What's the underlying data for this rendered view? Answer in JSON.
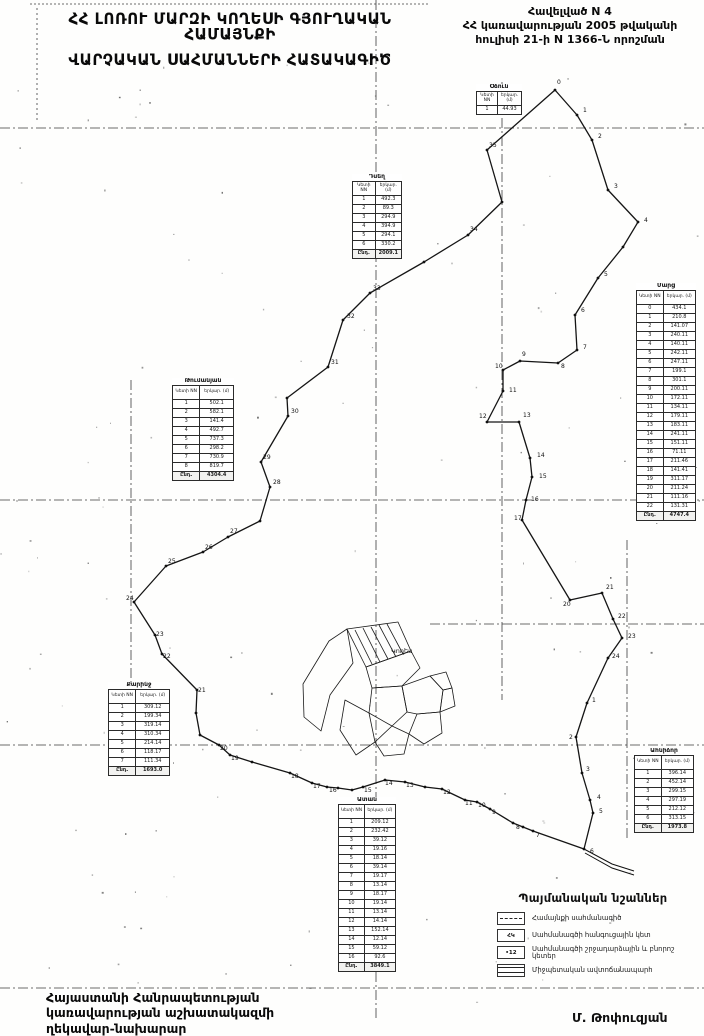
{
  "header": {
    "title_line1": "ՀՀ ԼՈՌՈՒ ՄԱՐԶԻ ԿՈՂԵՍԻ ԳՅՈՒՂԱԿԱՆ ՀԱՄԱՅՆՔԻ",
    "title_line2": "ՎԱՐՉԱԿԱՆ ՍԱՀՄԱՆՆԵՐԻ ՀԱՏԱԿԱԳԻԾ"
  },
  "annex": {
    "line1": "Հավելված N 4",
    "line2": "ՀՀ կառավարության  2005 թվականի",
    "line3": "հուլիսի 21-ի N 1366-Ն որոշման"
  },
  "map": {
    "village_label": "Կողես",
    "village_label_x": 391,
    "village_label_y": 653,
    "boundary": "555,90 577,115 592,140 608,190 638,222 623,247 598,278 575,315 577,350 558,363 520,361 503,370 503,391 487,422 519,422 530,458 532,477 526,500 522,520 570,600 602,593 613,619 622,638 608,658 587,703 576,737 582,773 590,800 593,813 584,849 533,831 523,827 513,823 490,809 477,802 465,800 442,789 425,787 405,782 385,780 363,787 352,790 338,788 327,787 312,783 290,773 252,762 230,755 219,745 200,735 196,713 197,690 162,654 155,635 134,602 166,566 203,552 228,537 260,521 270,487 261,462 288,416 287,398 328,367 343,320 370,293 424,262 468,235 502,202 487,150",
    "grid": [
      {
        "x1": 30,
        "y1": 4,
        "x2": 430,
        "y2": 4,
        "dash": "2 2"
      },
      {
        "x1": 0,
        "y1": 128,
        "x2": 704,
        "y2": 128,
        "dash": "10 3 2 3"
      },
      {
        "x1": 0,
        "y1": 500,
        "x2": 704,
        "y2": 500,
        "dash": "10 3 2 3"
      },
      {
        "x1": 430,
        "y1": 624,
        "x2": 704,
        "y2": 624,
        "dash": "10 3 2 3"
      },
      {
        "x1": 0,
        "y1": 745,
        "x2": 704,
        "y2": 745,
        "dash": "10 3 2 3"
      },
      {
        "x1": 0,
        "y1": 988,
        "x2": 704,
        "y2": 988,
        "dash": "10 3 2 3"
      },
      {
        "x1": 37,
        "y1": 8,
        "x2": 37,
        "y2": 120,
        "dash": "2 3"
      },
      {
        "x1": 131,
        "y1": 380,
        "x2": 131,
        "y2": 760,
        "dash": "10 3 2 3"
      },
      {
        "x1": 376,
        "y1": 0,
        "x2": 376,
        "y2": 1020,
        "dash": "10 3 2 3"
      },
      {
        "x1": 502,
        "y1": 82,
        "x2": 502,
        "y2": 700,
        "dash": "10 3 2 3"
      },
      {
        "x1": 627,
        "y1": 540,
        "x2": 627,
        "y2": 840,
        "dash": "10 3 2 3"
      }
    ],
    "point_labels": [
      [
        557,
        84,
        "0"
      ],
      [
        583,
        112,
        "1"
      ],
      [
        598,
        138,
        "2"
      ],
      [
        614,
        188,
        "3"
      ],
      [
        644,
        222,
        "4"
      ],
      [
        604,
        276,
        "5"
      ],
      [
        581,
        312,
        "6"
      ],
      [
        583,
        349,
        "7"
      ],
      [
        561,
        368,
        "8"
      ],
      [
        522,
        356,
        "9"
      ],
      [
        495,
        368,
        "10"
      ],
      [
        509,
        392,
        "11"
      ],
      [
        479,
        418,
        "12"
      ],
      [
        523,
        417,
        "13"
      ],
      [
        537,
        457,
        "14"
      ],
      [
        539,
        478,
        "15"
      ],
      [
        531,
        501,
        "16"
      ],
      [
        514,
        520,
        "17"
      ],
      [
        563,
        606,
        "20"
      ],
      [
        606,
        589,
        "21"
      ],
      [
        618,
        618,
        "22"
      ],
      [
        628,
        638,
        "23"
      ],
      [
        612,
        658,
        "24"
      ],
      [
        592,
        702,
        "1"
      ],
      [
        569,
        739,
        "2"
      ],
      [
        586,
        771,
        "3"
      ],
      [
        597,
        799,
        "4"
      ],
      [
        599,
        813,
        "5"
      ],
      [
        590,
        853,
        "6"
      ],
      [
        536,
        837,
        "7"
      ],
      [
        516,
        829,
        "8"
      ],
      [
        492,
        814,
        "9"
      ],
      [
        478,
        807,
        "10"
      ],
      [
        465,
        805,
        "11"
      ],
      [
        443,
        794,
        "12"
      ],
      [
        406,
        787,
        "13"
      ],
      [
        385,
        785,
        "14"
      ],
      [
        364,
        792,
        "15"
      ],
      [
        329,
        792,
        "16"
      ],
      [
        313,
        788,
        "17"
      ],
      [
        291,
        778,
        "18"
      ],
      [
        231,
        760,
        "19"
      ],
      [
        220,
        750,
        "20"
      ],
      [
        198,
        692,
        "21"
      ],
      [
        163,
        658,
        "22"
      ],
      [
        156,
        636,
        "23"
      ],
      [
        126,
        600,
        "24"
      ],
      [
        168,
        563,
        "25"
      ],
      [
        205,
        549,
        "26"
      ],
      [
        230,
        533,
        "27"
      ],
      [
        273,
        484,
        "28"
      ],
      [
        263,
        459,
        "29"
      ],
      [
        291,
        413,
        "30"
      ],
      [
        331,
        364,
        "31"
      ],
      [
        347,
        318,
        "32"
      ],
      [
        373,
        290,
        "33"
      ],
      [
        470,
        231,
        "34"
      ],
      [
        489,
        147,
        "35"
      ]
    ],
    "village_polygons": [
      "303,684 329,641 347,629 353,663 330,695 321,731 304,717",
      "347,629 398,622 411,651 366,667",
      "366,667 411,651 420,668 402,686 372,688",
      "372,688 402,686 407,712 392,726 369,713",
      "402,686 430,676 443,690 440,712 417,714 407,712",
      "417,714 440,712 442,733 424,744 409,734",
      "392,726 409,734 404,754 384,756 375,742",
      "345,700 369,713 375,742 356,755 340,730",
      "430,676 446,672 452,688 443,690",
      "443,690 452,688 455,706 440,712"
    ],
    "village_stripes": [
      [
        355,
        630,
        372,
        664
      ],
      [
        363,
        628,
        380,
        662
      ],
      [
        371,
        627,
        388,
        659
      ],
      [
        379,
        625,
        396,
        657
      ],
      [
        387,
        624,
        403,
        654
      ]
    ],
    "road": [
      "584,849 612,864 634,871",
      "585,853 612,868 634,875"
    ]
  },
  "tables": [
    {
      "title": "Օձուն",
      "x": 476,
      "y": 84,
      "w": 46,
      "hdr": [
        "Կետի NN",
        "երկար. (մ)"
      ],
      "rows": [
        [
          "1",
          "44.93"
        ]
      ],
      "total": null
    },
    {
      "title": "Դսեղ",
      "x": 352,
      "y": 174,
      "w": 50,
      "hdr": [
        "Կետի NN",
        "երկար. (մ)"
      ],
      "rows": [
        [
          "1",
          "492.3"
        ],
        [
          "2",
          "89.3"
        ],
        [
          "3",
          "294.9"
        ],
        [
          "4",
          "394.9"
        ],
        [
          "5",
          "294.1"
        ],
        [
          "6",
          "330.2"
        ]
      ],
      "total": [
        "Ընդ.",
        "2009.1"
      ]
    },
    {
      "title": "Մարց",
      "x": 636,
      "y": 283,
      "w": 60,
      "hdr": [
        "Կետի NN",
        "երկար. (մ)"
      ],
      "rows": [
        [
          "0",
          "434.1"
        ],
        [
          "1",
          "210.8"
        ],
        [
          "2",
          "141.07"
        ],
        [
          "3",
          "240.11"
        ],
        [
          "4",
          "140.11"
        ],
        [
          "5",
          "242.11"
        ],
        [
          "6",
          "247.11"
        ],
        [
          "7",
          "199.1"
        ],
        [
          "8",
          "301.1"
        ],
        [
          "9",
          "200.11"
        ],
        [
          "10",
          "172.11"
        ],
        [
          "11",
          "134.11"
        ],
        [
          "12",
          "179.11"
        ],
        [
          "13",
          "183.11"
        ],
        [
          "14",
          "241.11"
        ],
        [
          "15",
          "151.11"
        ],
        [
          "16",
          "71.11"
        ],
        [
          "17",
          "211.46"
        ],
        [
          "18",
          "141.41"
        ],
        [
          "19",
          "311.17"
        ],
        [
          "20",
          "211.24"
        ],
        [
          "21",
          "111.16"
        ],
        [
          "22",
          "131.31"
        ]
      ],
      "total": [
        "Ընդ.",
        "4747.4"
      ]
    },
    {
      "title": "Թումանյան",
      "x": 172,
      "y": 378,
      "w": 62,
      "hdr": [
        "Կետի NN",
        "երկար. (մ)"
      ],
      "rows": [
        [
          "1",
          "502.1"
        ],
        [
          "2",
          "582.1"
        ],
        [
          "3",
          "141.4"
        ],
        [
          "4",
          "492.7"
        ],
        [
          "5",
          "737.3"
        ],
        [
          "6",
          "298.2"
        ],
        [
          "7",
          "730.9"
        ],
        [
          "8",
          "819.7"
        ]
      ],
      "total": [
        "Ընդ.",
        "4304.4"
      ]
    },
    {
      "title": "Քարինջ",
      "x": 108,
      "y": 682,
      "w": 62,
      "hdr": [
        "Կետի NN",
        "երկար. (մ)"
      ],
      "rows": [
        [
          "1",
          "309.12"
        ],
        [
          "2",
          "199.34"
        ],
        [
          "3",
          "319.14"
        ],
        [
          "4",
          "310.34"
        ],
        [
          "5",
          "214.14"
        ],
        [
          "6",
          "118.17"
        ],
        [
          "7",
          "111.34"
        ]
      ],
      "total": [
        "Ընդ.",
        "1693.0"
      ]
    },
    {
      "title": "Ատան",
      "x": 338,
      "y": 797,
      "w": 58,
      "hdr": [
        "Կետի NN",
        "երկար. (մ)"
      ],
      "rows": [
        [
          "1",
          "209.12"
        ],
        [
          "2",
          "232.42"
        ],
        [
          "3",
          "39.12"
        ],
        [
          "4",
          "19.16"
        ],
        [
          "5",
          "18.14"
        ],
        [
          "6",
          "39.14"
        ],
        [
          "7",
          "19.17"
        ],
        [
          "8",
          "13.14"
        ],
        [
          "9",
          "18.17"
        ],
        [
          "10",
          "19.14"
        ],
        [
          "11",
          "13.14"
        ],
        [
          "12",
          "14.14"
        ],
        [
          "13",
          "152.14"
        ],
        [
          "14",
          "12.14"
        ],
        [
          "15",
          "59.12"
        ],
        [
          "16",
          "92.6"
        ]
      ],
      "total": [
        "Ընդ.",
        "3849.1"
      ]
    },
    {
      "title": "Ահնիձոր",
      "x": 634,
      "y": 748,
      "w": 60,
      "hdr": [
        "Կետի NN",
        "երկար. (մ)"
      ],
      "rows": [
        [
          "1",
          "396.14"
        ],
        [
          "2",
          "452.14"
        ],
        [
          "3",
          "299.15"
        ],
        [
          "4",
          "297.19"
        ],
        [
          "5",
          "212.12"
        ],
        [
          "6",
          "313.15"
        ]
      ],
      "total": [
        "Ընդ.",
        "1973.8"
      ]
    }
  ],
  "legend": {
    "title": "Պայմանական նշաններ",
    "items": [
      {
        "icon": "dashdot",
        "icon_text": "",
        "label": "Համայնքի սահմանագիծ"
      },
      {
        "icon": "node",
        "icon_text": "ՀԿ",
        "label": "Սահմանագծի հանգուցային կետ"
      },
      {
        "icon": "point",
        "icon_text": "•12",
        "label": "Սահմանագծի շրջադարձային և բնորոշ կետեր"
      },
      {
        "icon": "road",
        "icon_text": "",
        "label": "Միջպետական ավտոճանապարհ"
      }
    ]
  },
  "footer": {
    "line1": "Հայաստանի Հանրապետության",
    "line2": "կառավարության աշխատակազմի",
    "line3": "ղեկավար-նախարար",
    "signature": "Մ. Թոփուզյան"
  }
}
